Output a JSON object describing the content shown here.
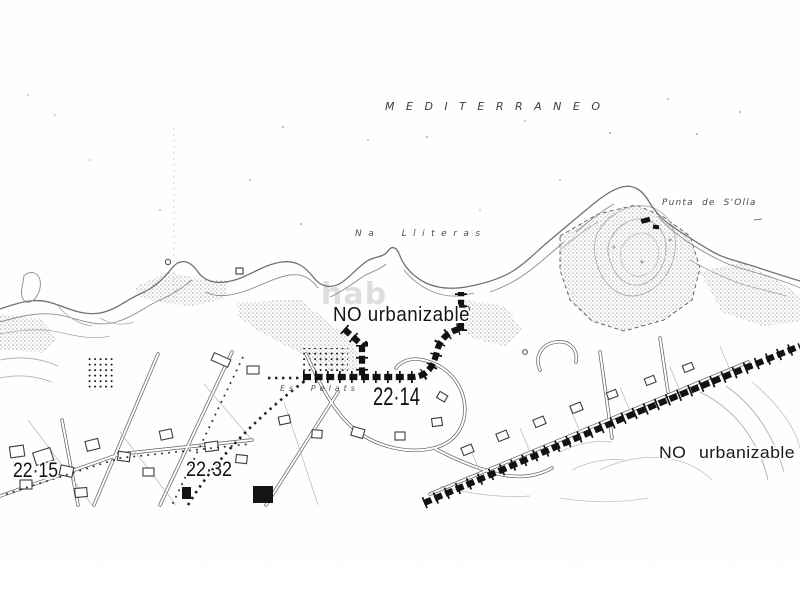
{
  "map": {
    "labels": {
      "sea": "MEDITERRANEO",
      "bay": "Na Lliteras",
      "cape": "Punta de S'Olla",
      "place": "Es Pelats",
      "zone_center": "NO urbanizable",
      "zone_right": "NO urbanizable",
      "parcel_center": "22·14",
      "parcel_left": "22·15",
      "parcel_mid": "22·32",
      "watermark": "hab"
    },
    "colors": {
      "paper": "#ffffff",
      "ink": "#1c1c1c",
      "line": "#707070",
      "faint": "#a8a8a8",
      "boundary": "#121212",
      "watermark": "#d9d9d9"
    }
  }
}
